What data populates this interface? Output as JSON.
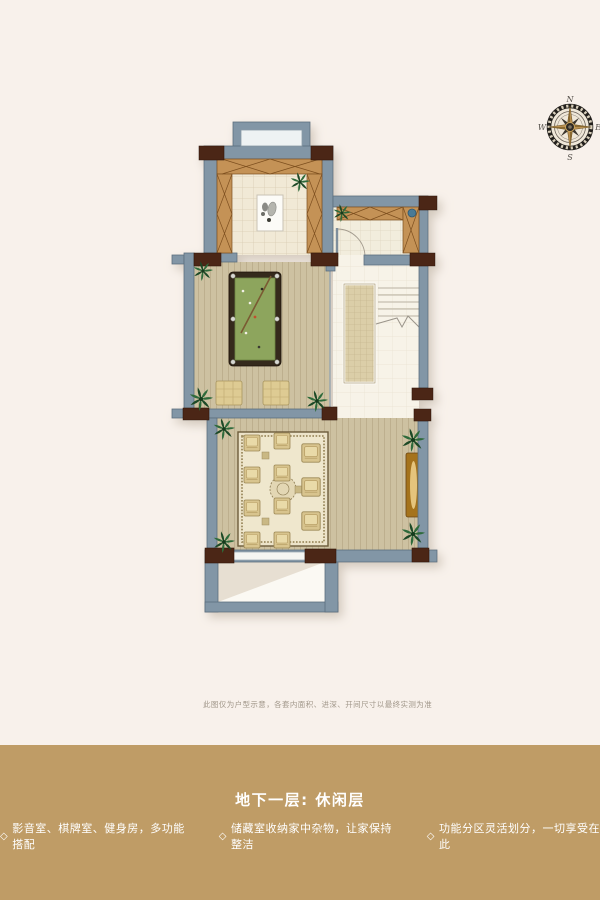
{
  "page": {
    "background": "#f8f1eb"
  },
  "compass": {
    "n": "N",
    "e": "E",
    "s": "S",
    "w": "W"
  },
  "plan": {
    "disclaimer": "此图仅为户型示意，各套内面积、进深、开间尺寸以最终实测为准"
  },
  "footer": {
    "band_color": "#bf9c66",
    "title": "地下一层: 休闲层",
    "bullets": [
      {
        "marker": "◇",
        "text": "影音室、棋牌室、健身房，多功能搭配"
      },
      {
        "marker": "◇",
        "text": "储藏室收纳家中杂物，让家保持整洁"
      },
      {
        "marker": "◇",
        "text": "功能分区灵活划分，一切享受在此"
      }
    ]
  },
  "colors": {
    "wall": "#8296a6",
    "wall_corner_block": "#4b2817",
    "cabinet_wood": "#c49257",
    "billiard_felt": "#8da55d",
    "gold_band": "#bf9c66",
    "plant_green": "#2e6b3a"
  }
}
